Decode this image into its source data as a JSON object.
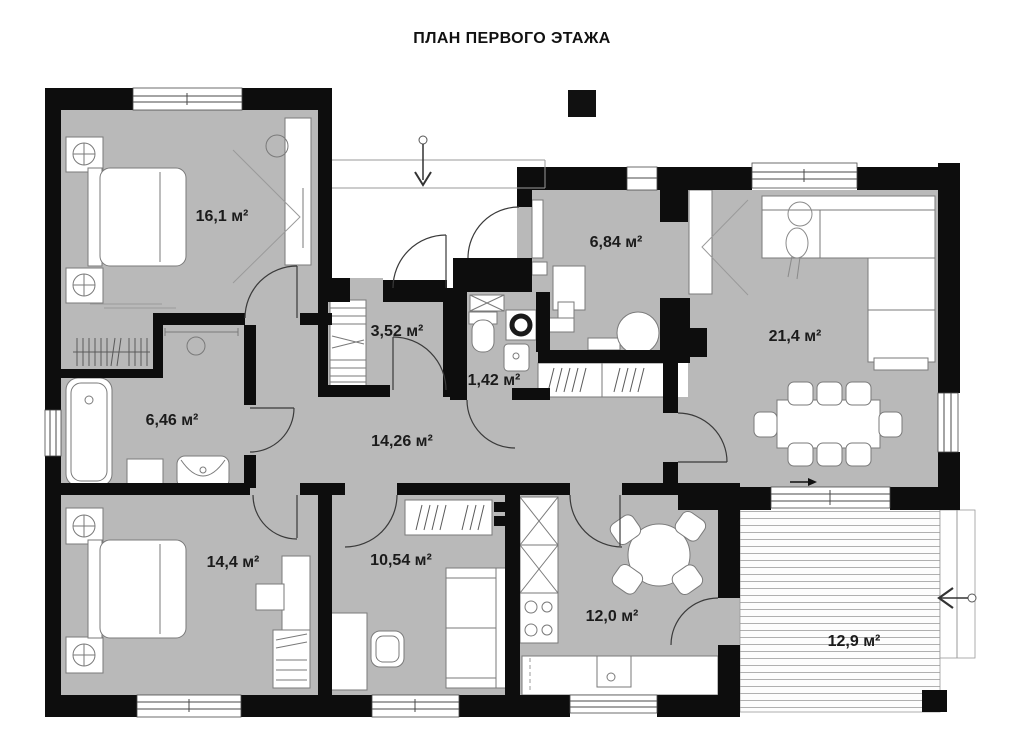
{
  "title": "ПЛАН ПЕРВОГО ЭТАЖА",
  "rooms": [
    {
      "id": "bedroom-1",
      "area": "16,1 м²"
    },
    {
      "id": "closet",
      "area": "3,52 м²"
    },
    {
      "id": "boiler-room",
      "area": "6,84 м²"
    },
    {
      "id": "living-room",
      "area": "21,4 м²"
    },
    {
      "id": "wc",
      "area": "1,42 м²"
    },
    {
      "id": "hallway",
      "area": "14,26 м²"
    },
    {
      "id": "bathroom",
      "area": "6,46 м²"
    },
    {
      "id": "bedroom-2",
      "area": "14,4 м²"
    },
    {
      "id": "office",
      "area": "10,54 м²"
    },
    {
      "id": "kitchen",
      "area": "12,0 м²"
    },
    {
      "id": "terrace",
      "area": "12,9 м²"
    }
  ]
}
